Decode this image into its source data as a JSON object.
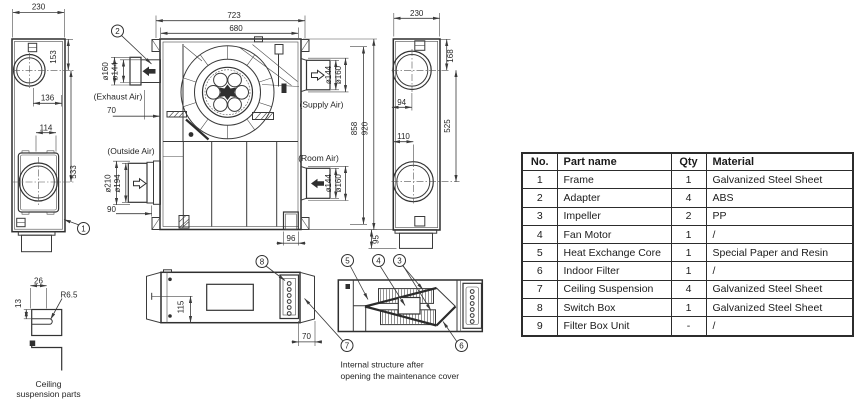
{
  "colors": {
    "line": "#3a3a3a",
    "text": "#262626",
    "table_border": "#2c2c2c",
    "background": "#ffffff"
  },
  "views": {
    "left_side": {
      "callout": "1",
      "dims": {
        "width": "230",
        "top_offset": "153",
        "upper_hole": "136",
        "height": "533",
        "lower_hole": "114"
      }
    },
    "plan": {
      "callout": "2",
      "dims": {
        "outer_width": "723",
        "inner_width": "680",
        "exhaust_offset": "70",
        "outside_offset": "90",
        "inner_height": "858",
        "outer_height": "920",
        "notch_width": "96",
        "foot_height": "95"
      },
      "ports": {
        "exhaust": {
          "label": "(Exhaust Air)",
          "dia_outer": "ø160",
          "dia_inner": "ø144"
        },
        "outside": {
          "label": "(Outside Air)",
          "dia_outer": "ø210",
          "dia_inner": "ø194"
        },
        "supply": {
          "label": "(Supply Air)",
          "dia_inner": "ø144",
          "dia_outer": "ø160"
        },
        "room": {
          "label": "(Room Air)",
          "dia_inner": "ø144",
          "dia_outer": "ø160"
        }
      }
    },
    "right_side": {
      "dims": {
        "width": "230",
        "top_offset": "168",
        "upper_hole": "94",
        "height": "525",
        "lower_hole": "110"
      }
    },
    "hook_detail": {
      "dims": {
        "width": "26",
        "thickness": "13",
        "radius": "R6.5"
      },
      "caption": [
        "Ceiling",
        "suspension parts"
      ]
    },
    "front": {
      "dims": {
        "height": "115",
        "offset": "70"
      },
      "callouts": {
        "switch_box": "8",
        "ceiling": "7"
      }
    },
    "internal": {
      "callouts": {
        "core": "5",
        "motor": "4",
        "impeller": "3",
        "filter": "6"
      },
      "caption": [
        "Internal structure after",
        "opening the maintenance cover"
      ]
    }
  },
  "parts_table": {
    "headers": [
      "No.",
      "Part name",
      "Qty",
      "Material"
    ],
    "rows": [
      [
        "1",
        "Frame",
        "1",
        "Galvanized Steel Sheet"
      ],
      [
        "2",
        "Adapter",
        "4",
        "ABS"
      ],
      [
        "3",
        "Impeller",
        "2",
        "PP"
      ],
      [
        "4",
        "Fan Motor",
        "1",
        "/"
      ],
      [
        "5",
        "Heat Exchange Core",
        "1",
        "Special Paper and Resin"
      ],
      [
        "6",
        "Indoor Filter",
        "1",
        "/"
      ],
      [
        "7",
        "Ceiling Suspension",
        "4",
        "Galvanized Steel Sheet"
      ],
      [
        "8",
        "Switch Box",
        "1",
        "Galvanized Steel Sheet"
      ],
      [
        "9",
        "Filter Box Unit",
        "-",
        "/"
      ]
    ]
  }
}
